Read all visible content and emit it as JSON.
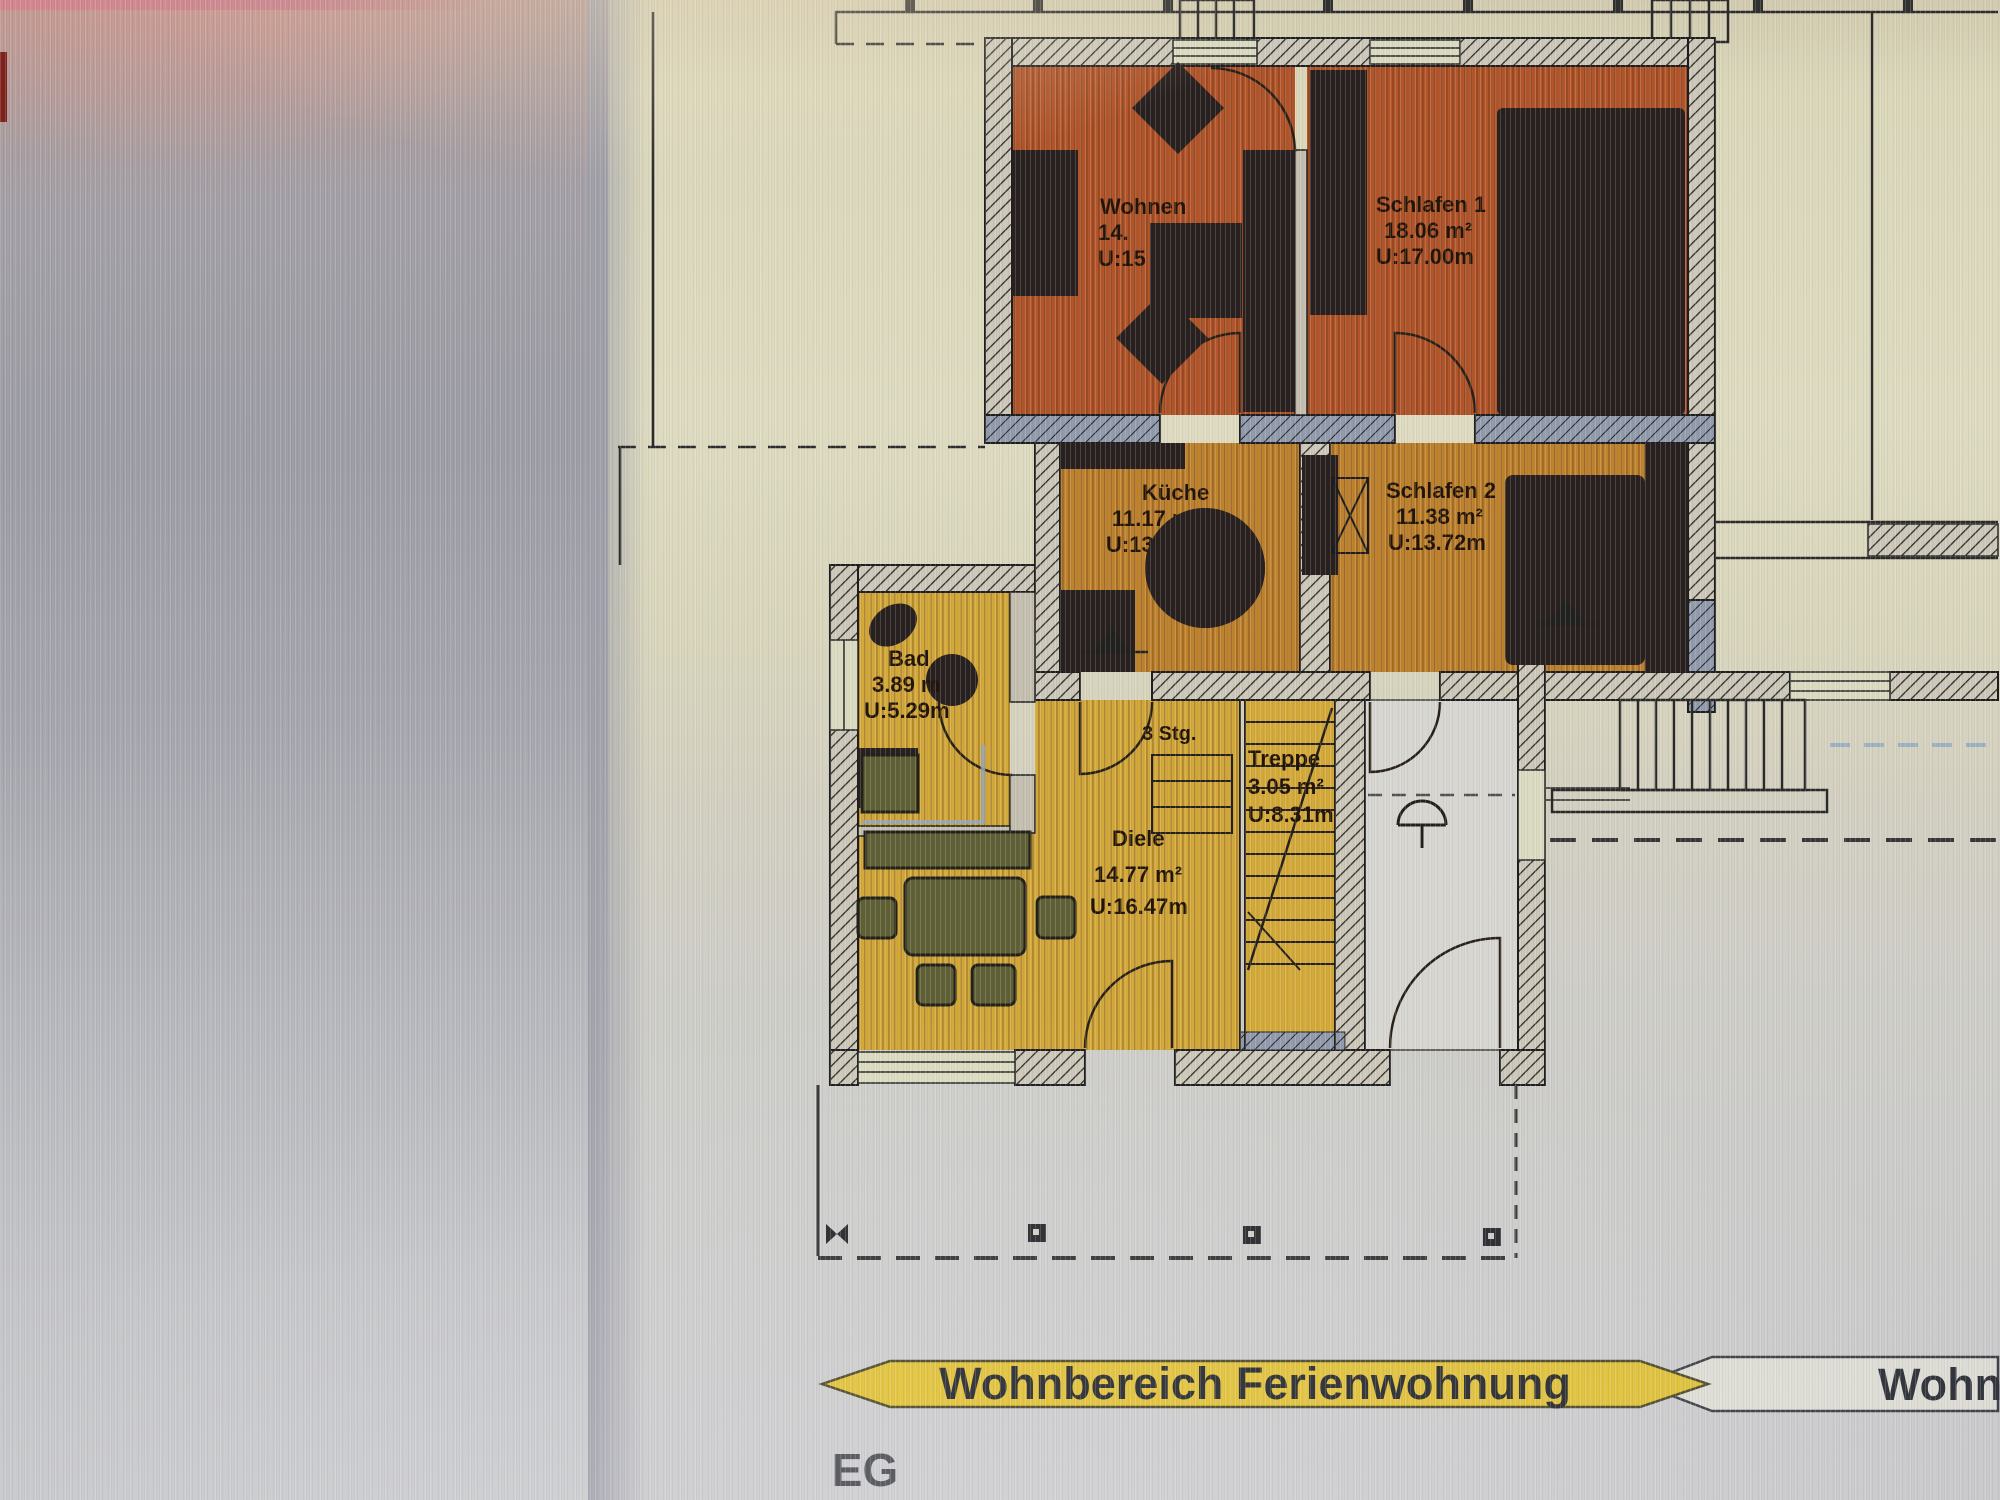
{
  "floor_label": "EG",
  "banner": {
    "left_text": "Wohnbereich Ferienwohnung",
    "right_text_partial": "Wohnb"
  },
  "rooms": {
    "wohnen": {
      "name": "Wohnen",
      "line2": "14.",
      "line3": "U:15"
    },
    "schlafen1": {
      "name": "Schlafen 1",
      "line2": "18.06 m²",
      "line3": "U:17.00m"
    },
    "kueche": {
      "name": "Küche",
      "line2": "11.17 m²",
      "line3": "U:13.58m"
    },
    "schlafen2": {
      "name": "Schlafen 2",
      "line2": "11.38 m²",
      "line3": "U:13.72m"
    },
    "bad": {
      "name": "Bad",
      "line2": "3.89 m",
      "line3": "U:5.29m"
    },
    "diele": {
      "name": "Diele",
      "line2": "14.77 m²",
      "line3": "U:16.47m"
    },
    "treppe": {
      "name": "Treppe",
      "line2": "3.05 m²",
      "line3": "U:8.31m"
    }
  },
  "labels": {
    "steps": "3 Stg."
  },
  "colors": {
    "room_living_orange": "#bc5a2c",
    "room_kitchen_amber": "#c9892f",
    "room_hall_yellow": "#deb23c",
    "banner_yellow": "#e9c93f",
    "banner_outline": "#4a4430",
    "wall_blue_gray": "#99a3b5",
    "furniture_dark": "#2a2220",
    "furniture_olive": "#646538",
    "white_room": "#e3e2dc",
    "paper_cream": "#e9e6c9",
    "screen_gray": "#aaaab3",
    "glare_pink": "#d79d92",
    "line_dark": "#222222"
  }
}
